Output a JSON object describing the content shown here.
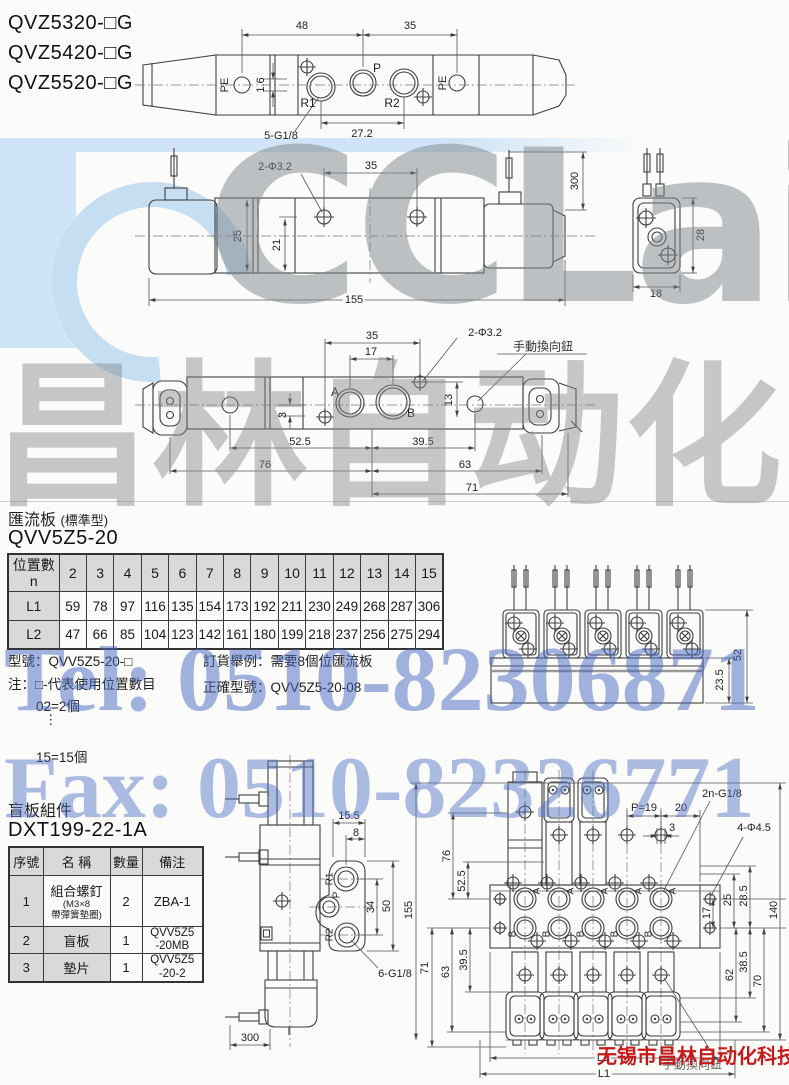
{
  "header": {
    "models": [
      "QVZ5320-□G",
      "QVZ5420-□G",
      "QVZ5520-□G"
    ]
  },
  "watermark": {
    "logo_text": "CCLair",
    "brand_text": "昌林自动化",
    "tel_text": "Tel: 0510-82306871",
    "fax_text": "Fax: 0510-82326771",
    "company_text": "无锡市昌林自动化科技",
    "accent_blue": "#4f6fc5",
    "accent_red": "#c41a1a",
    "light_blue": "#cfe4f6",
    "watermark_gray": "#85898e"
  },
  "drawing_top_view": {
    "dims": {
      "d48": "48",
      "d35": "35",
      "d1_6": "1.6",
      "d27_2": "27.2"
    },
    "labels": {
      "pe_left": "PE",
      "pe_right": "PE",
      "r1": "R1",
      "p": "P",
      "r2": "R2",
      "thread": "5-G1/8"
    }
  },
  "drawing_front_view": {
    "dims": {
      "holes": "2-Φ3.2",
      "d35": "35",
      "d25": "25",
      "d21": "21",
      "d155": "155",
      "d300": "300",
      "d28": "28",
      "d18": "18"
    }
  },
  "drawing_bottom_view": {
    "dims": {
      "d35": "35",
      "d17": "17",
      "holes": "2-Φ3.2",
      "d3": "3",
      "d13": "13",
      "d52_5": "52.5",
      "d39_5": "39.5",
      "d76": "76",
      "d63": "63",
      "d71": "71"
    },
    "labels": {
      "a": "A",
      "b": "B",
      "manual_override": "手動換向鈕"
    }
  },
  "manifold_section": {
    "title": "匯流板",
    "title_note": "(標準型)",
    "model": "QVV5Z5-20",
    "table": {
      "corner_line1": "位置數",
      "corner_line2": "n",
      "cols": [
        "2",
        "3",
        "4",
        "5",
        "6",
        "7",
        "8",
        "9",
        "10",
        "11",
        "12",
        "13",
        "14",
        "15"
      ],
      "l1_label": "L1",
      "l1": [
        "59",
        "78",
        "97",
        "116",
        "135",
        "154",
        "173",
        "192",
        "211",
        "230",
        "249",
        "268",
        "287",
        "306"
      ],
      "l2_label": "L2",
      "l2": [
        "47",
        "66",
        "85",
        "104",
        "123",
        "142",
        "161",
        "180",
        "199",
        "218",
        "237",
        "256",
        "275",
        "294"
      ]
    },
    "notes_left": {
      "line1": "型號：QVV5Z5-20-□",
      "line2": "注：□-代表使用位置數目",
      "line3": "02=2個",
      "dots": "⋮",
      "line4": "15=15個"
    },
    "notes_right": {
      "line1": "訂貨舉例：需要8個位匯流板",
      "line2": "正確型號：QVV5Z5-20-08"
    },
    "assembly_dims": {
      "d52": "52",
      "d23_5": "23.5"
    }
  },
  "blank_plate_section": {
    "title": "盲板組件",
    "model": "DXT199-22-1A",
    "table": {
      "headers": [
        "序號",
        "名 稱",
        "數量",
        "備注"
      ],
      "rows": [
        {
          "no": "1",
          "name": "組合螺釘",
          "name_sub1": "(M3×8",
          "name_sub2": "帶彈簧墊圈)",
          "qty": "2",
          "remark": "ZBA-1",
          "remark2": ""
        },
        {
          "no": "2",
          "name": "盲板",
          "qty": "1",
          "remark": "QVV5Z5",
          "remark2": "-20MB"
        },
        {
          "no": "3",
          "name": "墊片",
          "qty": "1",
          "remark": "QVV5Z5",
          "remark2": "-20-2"
        }
      ]
    }
  },
  "drawing_side_view": {
    "dims": {
      "d15_5": "15.5",
      "d8": "8",
      "d34": "34",
      "d50": "50",
      "d300": "300"
    },
    "labels": {
      "r1": "R1",
      "p": "P",
      "r2": "R2",
      "thread": "6-G1/8"
    }
  },
  "drawing_manifold_assembly": {
    "labels": {
      "thread": "2n-G1/8",
      "holes": "4-Φ4.5",
      "a": "A",
      "b": "B",
      "manual_override": "手動換向鈕"
    },
    "dims": {
      "p_pitch": "P=19",
      "d20": "20",
      "d3": "3",
      "d76": "76",
      "d52_5": "52.5",
      "d155": "155",
      "d39_5": "39.5",
      "d71": "71",
      "d63": "63",
      "d25": "25",
      "d28_5": "28.5",
      "d17": "17",
      "d140": "140",
      "d38_5": "38.5",
      "d62": "62",
      "d70": "70",
      "l1": "L1",
      "l2": "L2"
    }
  }
}
